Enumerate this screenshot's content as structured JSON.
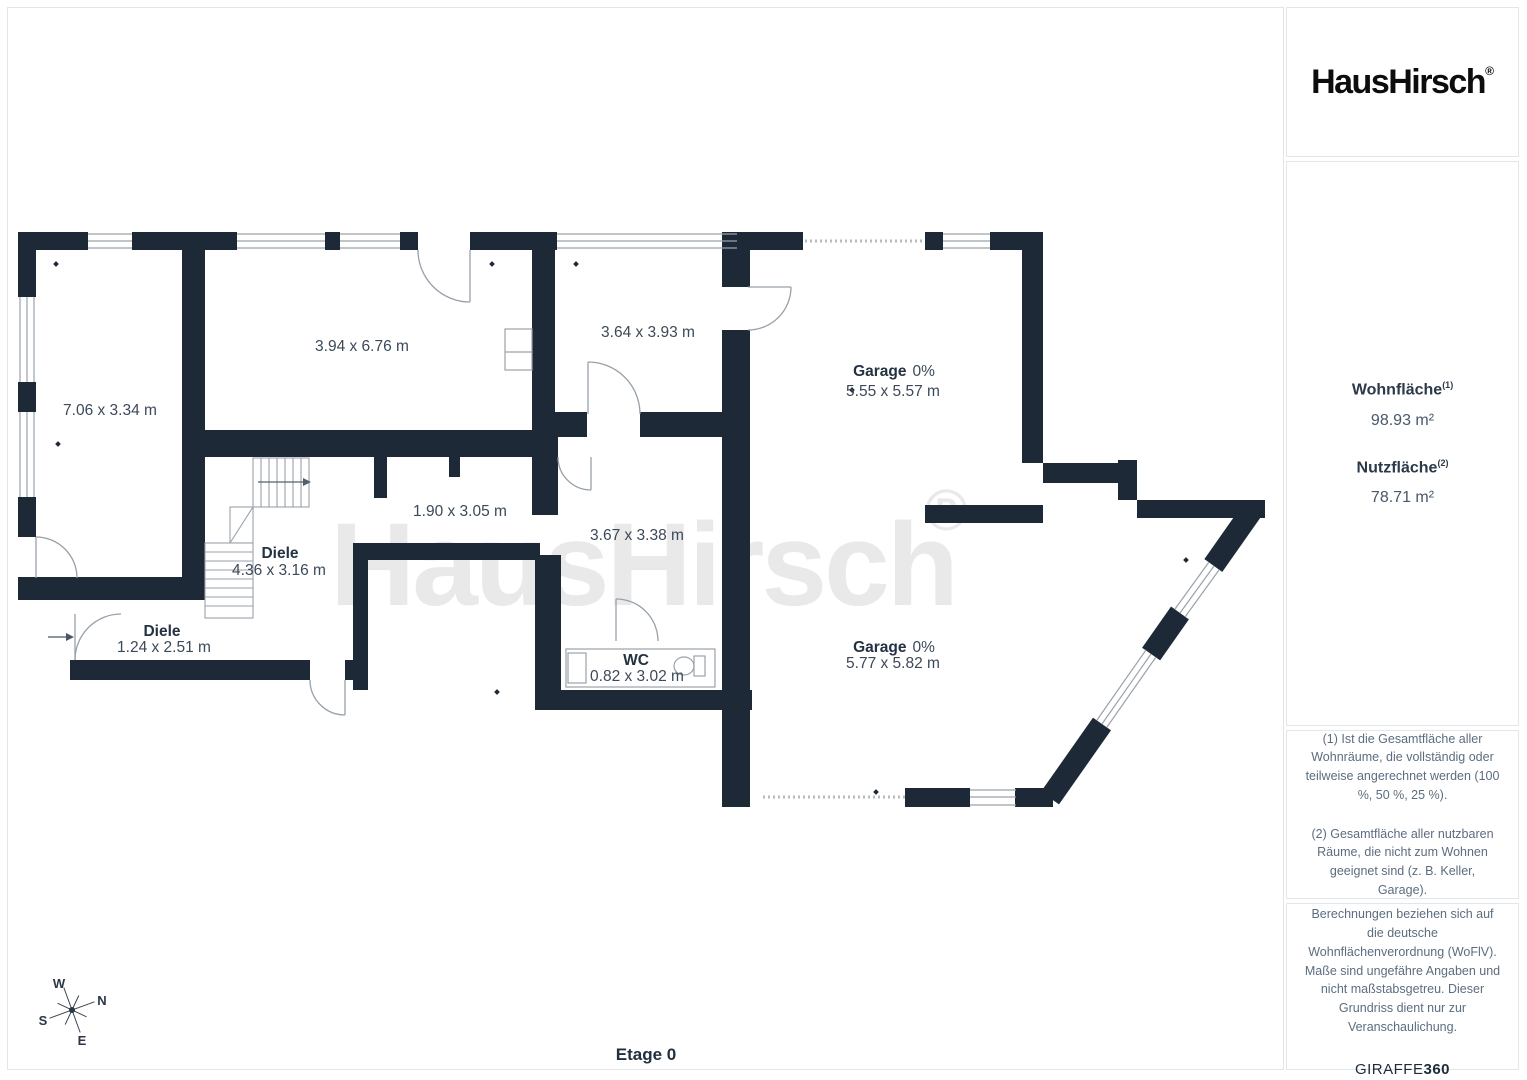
{
  "sidebar": {
    "logo": "HausHirsch",
    "logo_mark": "®",
    "stats": [
      {
        "label": "Wohnfläche",
        "sup": "(1)",
        "value": "98.93 m²"
      },
      {
        "label": "Nutzfläche",
        "sup": "(2)",
        "value": "78.71 m²"
      }
    ],
    "footnote1": "(1) Ist die Gesamtfläche aller Wohnräume, die vollständig oder teilweise angerechnet werden (100 %, 50 %, 25 %).",
    "footnote2": "(2) Gesamtfläche aller nutzbaren Räume, die nicht zum Wohnen geeignet sind (z. B. Keller, Garage).",
    "disclaimer": "Berechnungen beziehen sich auf die deutsche Wohnflächenverordnung (WoFlV). Maße sind ungefähre Angaben und nicht maßstabsgetreu. Dieser Grundriss dient nur zur Veranschaulichung.",
    "brand_name": "GIRAFFE",
    "brand_suffix": "360"
  },
  "plan": {
    "floor_label": "Etage 0",
    "watermark": "HausHirsch",
    "watermark_mark": "®",
    "compass": {
      "n": "N",
      "s": "S",
      "e": "E",
      "w": "W"
    },
    "rooms": [
      {
        "name": "",
        "dims": "7.06 x 3.34 m"
      },
      {
        "name": "",
        "dims": "3.94 x 6.76 m"
      },
      {
        "name": "",
        "dims": "3.64 x 3.93 m"
      },
      {
        "name": "Garage",
        "pct": "0%",
        "dims": "5.55 x 5.57 m"
      },
      {
        "name": "",
        "dims": "1.90 x 3.05 m"
      },
      {
        "name": "",
        "dims": "3.67 x 3.38 m"
      },
      {
        "name": "Diele",
        "dims": "4.36 x 3.16 m"
      },
      {
        "name": "Diele",
        "dims": "1.24 x 2.51 m"
      },
      {
        "name": "WC",
        "dims": "0.82 x 3.02 m"
      },
      {
        "name": "Garage",
        "pct": "0%",
        "dims": "5.77 x 5.82 m"
      }
    ],
    "colors": {
      "wall": "#1d2936",
      "accent": "#9aa2ab",
      "watermark": "#e9e9e9"
    }
  }
}
